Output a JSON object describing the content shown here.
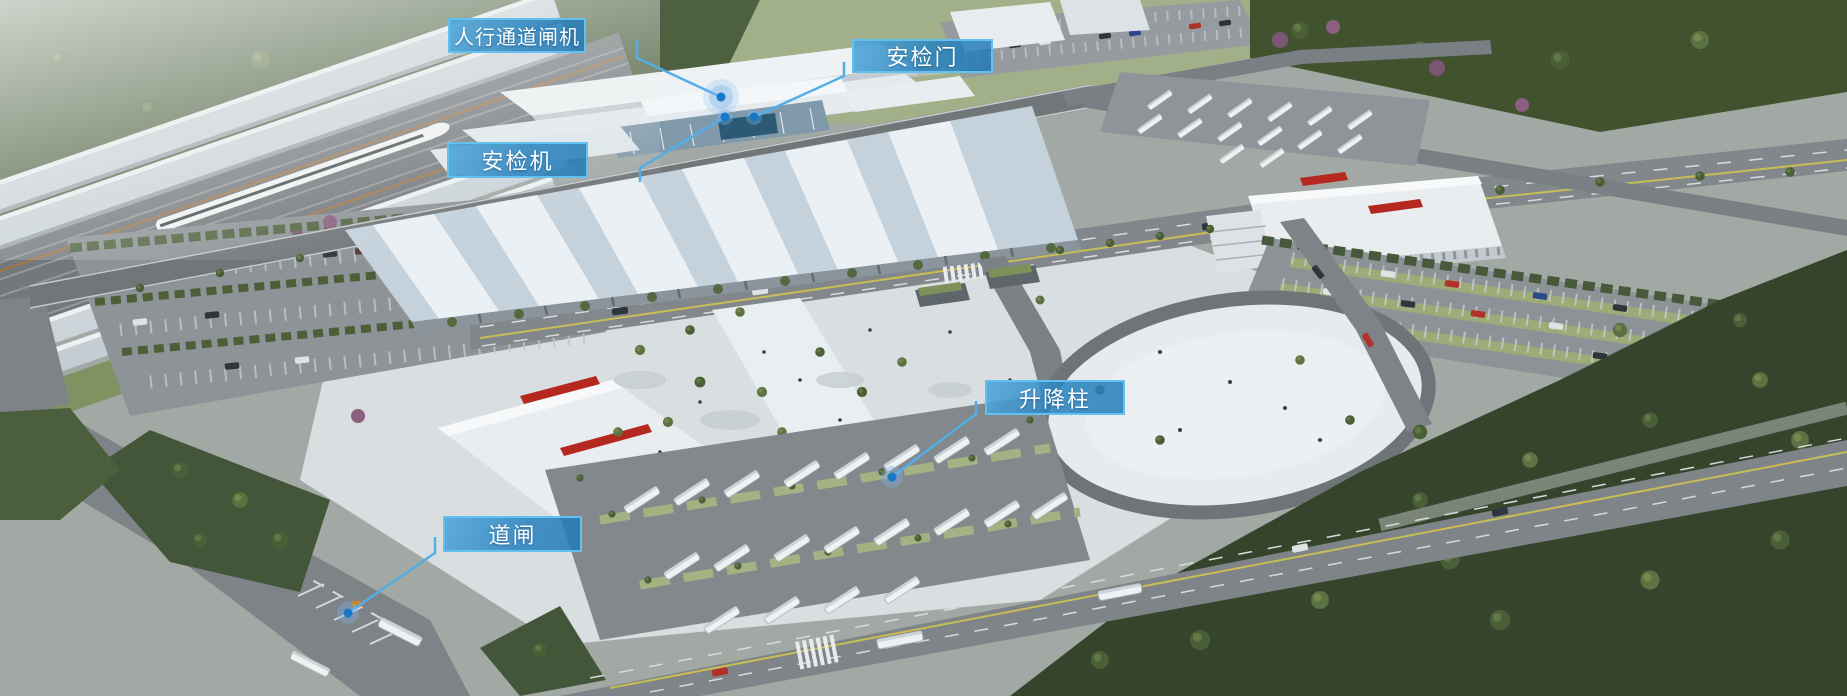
{
  "scene_title": "station-aerial-render",
  "callouts": [
    {
      "id": "pedestrian-turnstile",
      "label": "人行通道闸机"
    },
    {
      "id": "security-door",
      "label": "安检门"
    },
    {
      "id": "security-scanner",
      "label": "安检机"
    },
    {
      "id": "lift-bollard",
      "label": "升降柱"
    },
    {
      "id": "road-barrier",
      "label": "道闸"
    }
  ],
  "colors": {
    "callout_fill": "#207ab8",
    "callout_border": "#62c1ef",
    "leader_line": "#55ade8",
    "marker_dot": "#1778c5",
    "marker_halo": "rgba(120,180,235,0.38)"
  }
}
